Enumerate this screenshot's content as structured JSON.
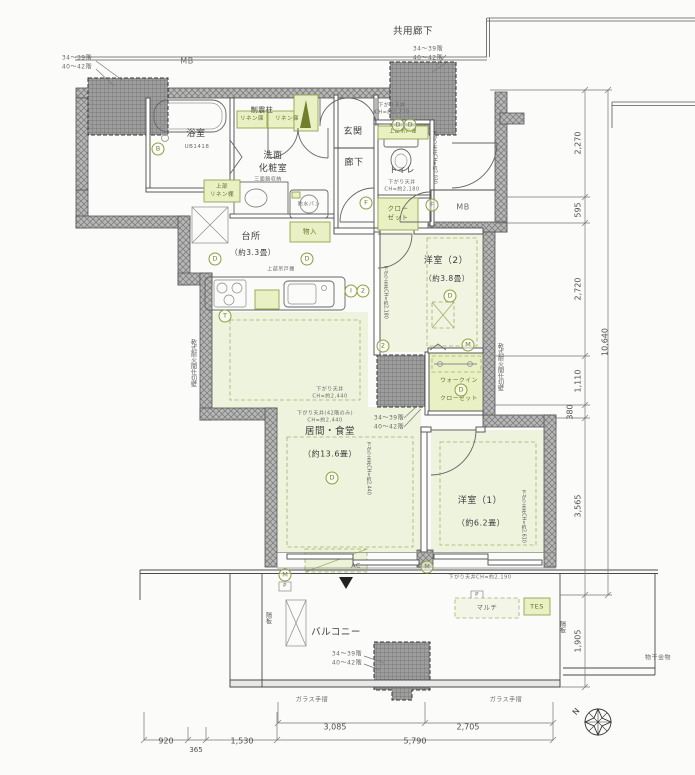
{
  "labels": {
    "common_corridor": "共用廊下",
    "mb": "MB",
    "floors_a": "34〜39階",
    "floors_b": "40〜42階",
    "bath": "浴室",
    "bath_unit": "UB1418",
    "damper_column": "制震柱",
    "linen": "リネン庫",
    "upper_linen_a": "上部",
    "upper_linen_b": "リネン棚",
    "mirror_cabinet": "三面鏡収納",
    "powder_a": "洗面",
    "powder_b": "化粧室",
    "waterproof_pan": "防水パン",
    "genkan": "玄関",
    "hallway": "廊下",
    "toilet": "トイレ",
    "soffit": "下がり天井",
    "soffit_genkan": "CH=約2,270",
    "soffit_toilet": "CH=約2,180",
    "upper_cabinet": "上部吊戸棚",
    "closet_a": "クロー",
    "closet_b": "ゼット",
    "kitchen": "台所",
    "kitchen_size": "（約3.3畳）",
    "storage": "物入",
    "bedroom2": "洋室（2）",
    "bedroom2_size": "（約3.8畳）",
    "wic_a": "ウォークイン",
    "wic_b": "クローゼット",
    "living": "居間・食堂",
    "living_size": "（約13.6畳）",
    "soffit_living": "CH=約2,440",
    "soffit_living42": "下がり天井(42階のみ)",
    "bedroom1": "洋室（1）",
    "bedroom1_size": "（約6.2畳）",
    "soffit_bedroom1": "下がり天井CH=約2,190",
    "ac": "AC",
    "multi": "マルチ",
    "tes": "TES",
    "balcony": "バルコニー",
    "glass_rail": "ガラス手摺",
    "laundry_fitting": "物干金物",
    "partition": "隔板",
    "firewall": "乾式耐火間仕切壁",
    "p": "P",
    "north": "N",
    "v_soffit_2180": "下がり天井CH=約2,180",
    "v_soffit_2030": "下がり天井CH=約2,030",
    "v_soffit_2440": "下がり天井CH=約2,440",
    "v_soffit_2610": "下がり天井CH=約2,610"
  },
  "dims": {
    "right": [
      "2,270",
      "595",
      "2,720",
      "1,110",
      "380",
      "3,565",
      "1,905"
    ],
    "right_total": "10,640",
    "bottom_upper": [
      "3,085",
      "2,705"
    ],
    "bottom_lower": [
      "920",
      "365",
      "1,530"
    ],
    "bottom_total": "5,790"
  },
  "symbols": [
    {
      "t": "D"
    },
    {
      "t": "D"
    },
    {
      "t": "F"
    },
    {
      "t": "F"
    },
    {
      "t": "D"
    },
    {
      "t": "D"
    },
    {
      "t": "T"
    },
    {
      "t": "I"
    },
    {
      "t": "2"
    },
    {
      "t": "D"
    },
    {
      "t": "2"
    },
    {
      "t": "M"
    },
    {
      "t": "D"
    },
    {
      "t": "D"
    },
    {
      "t": "M"
    },
    {
      "t": "M"
    },
    {
      "t": "B"
    }
  ],
  "colors": {
    "wall_hatch": "#b3b3b3",
    "column_fill": "#9a9a9a",
    "fixture_green": "#e9f0c4",
    "floor_green": "#eef3dd",
    "accent_text_green": "#5f7226"
  }
}
